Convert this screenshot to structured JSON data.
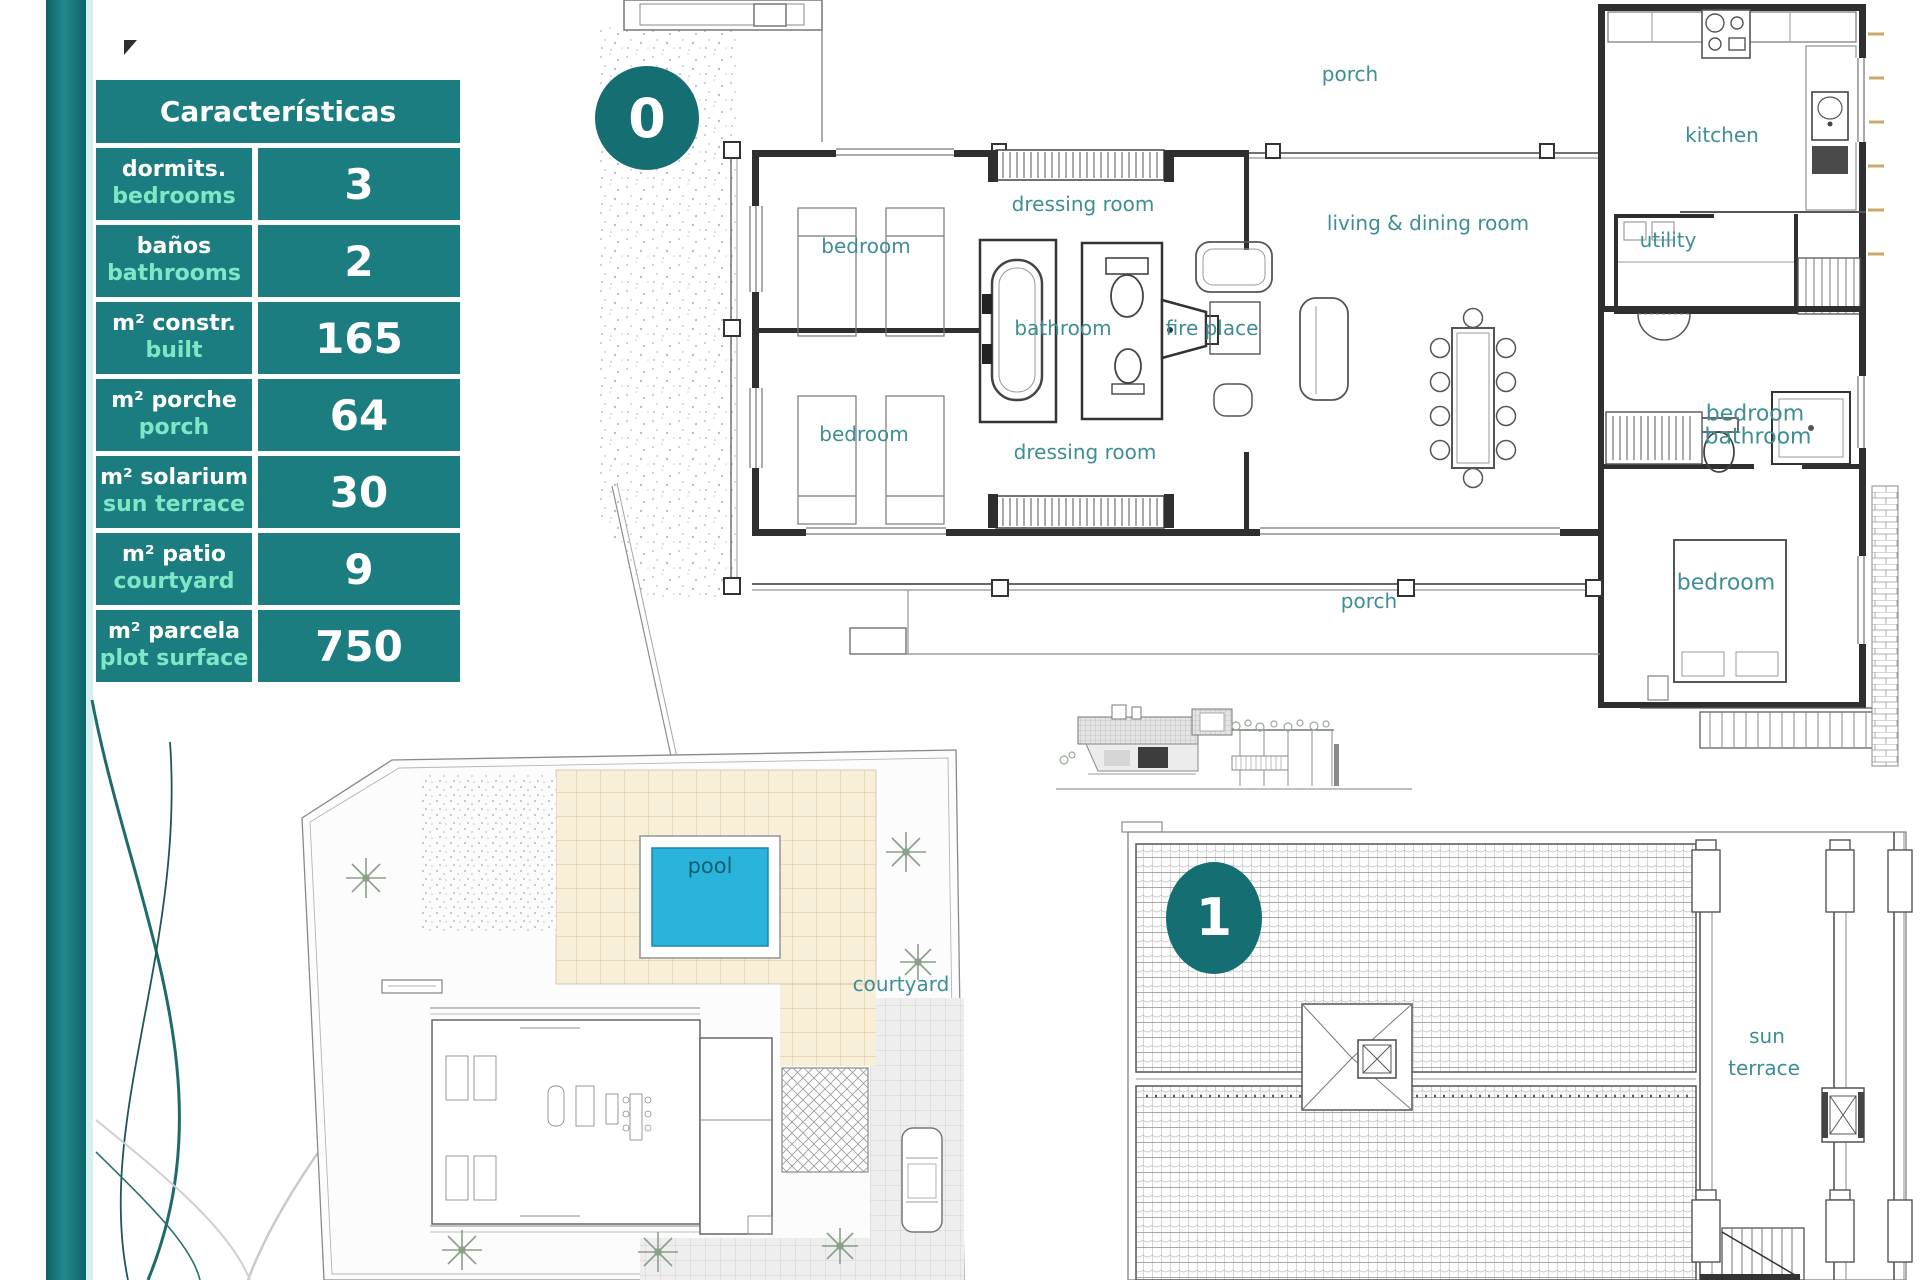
{
  "table": {
    "header": "Características",
    "rows": [
      {
        "es": "dormits.",
        "en": "bedrooms",
        "value": "3"
      },
      {
        "es": "baños",
        "en": "bathrooms",
        "value": "2"
      },
      {
        "es": "m² constr.",
        "en": "built",
        "value": "165"
      },
      {
        "es": "m² porche",
        "en": "porch",
        "value": "64"
      },
      {
        "es": "m² solarium",
        "en": "sun terrace",
        "value": "30"
      },
      {
        "es": "m² patio",
        "en": "courtyard",
        "value": "9"
      },
      {
        "es": "m² parcela",
        "en": "plot surface",
        "value": "750"
      }
    ]
  },
  "badges": {
    "ground_floor": "0",
    "first_floor": "1"
  },
  "floor0_labels": {
    "porch_top": "porch",
    "kitchen": "kitchen",
    "dressing_room_top": "dressing room",
    "living_dining": "living & dining room",
    "utility": "utility",
    "bedroom_top_left": "bedroom",
    "bathroom_center": "bathroom",
    "fire_place": "fire place",
    "bedroom_right": "bedroom",
    "bathroom_right": "bathroom",
    "bedroom_bottom_left": "bedroom",
    "dressing_room_bottom": "dressing room",
    "porch_bottom": "porch",
    "bedroom_bottom_right": "bedroom"
  },
  "site_labels": {
    "pool": "pool",
    "courtyard": "courtyard"
  },
  "roof_labels": {
    "sun": "sun",
    "terrace": "terrace"
  },
  "colors": {
    "teal": "#1b7d7f",
    "badge_teal": "#156f72",
    "mint": "#7de8c6",
    "plan_label": "#3f8d95",
    "pool_blue": "#2ab4dc",
    "paving_beige": "#f7efd8"
  }
}
